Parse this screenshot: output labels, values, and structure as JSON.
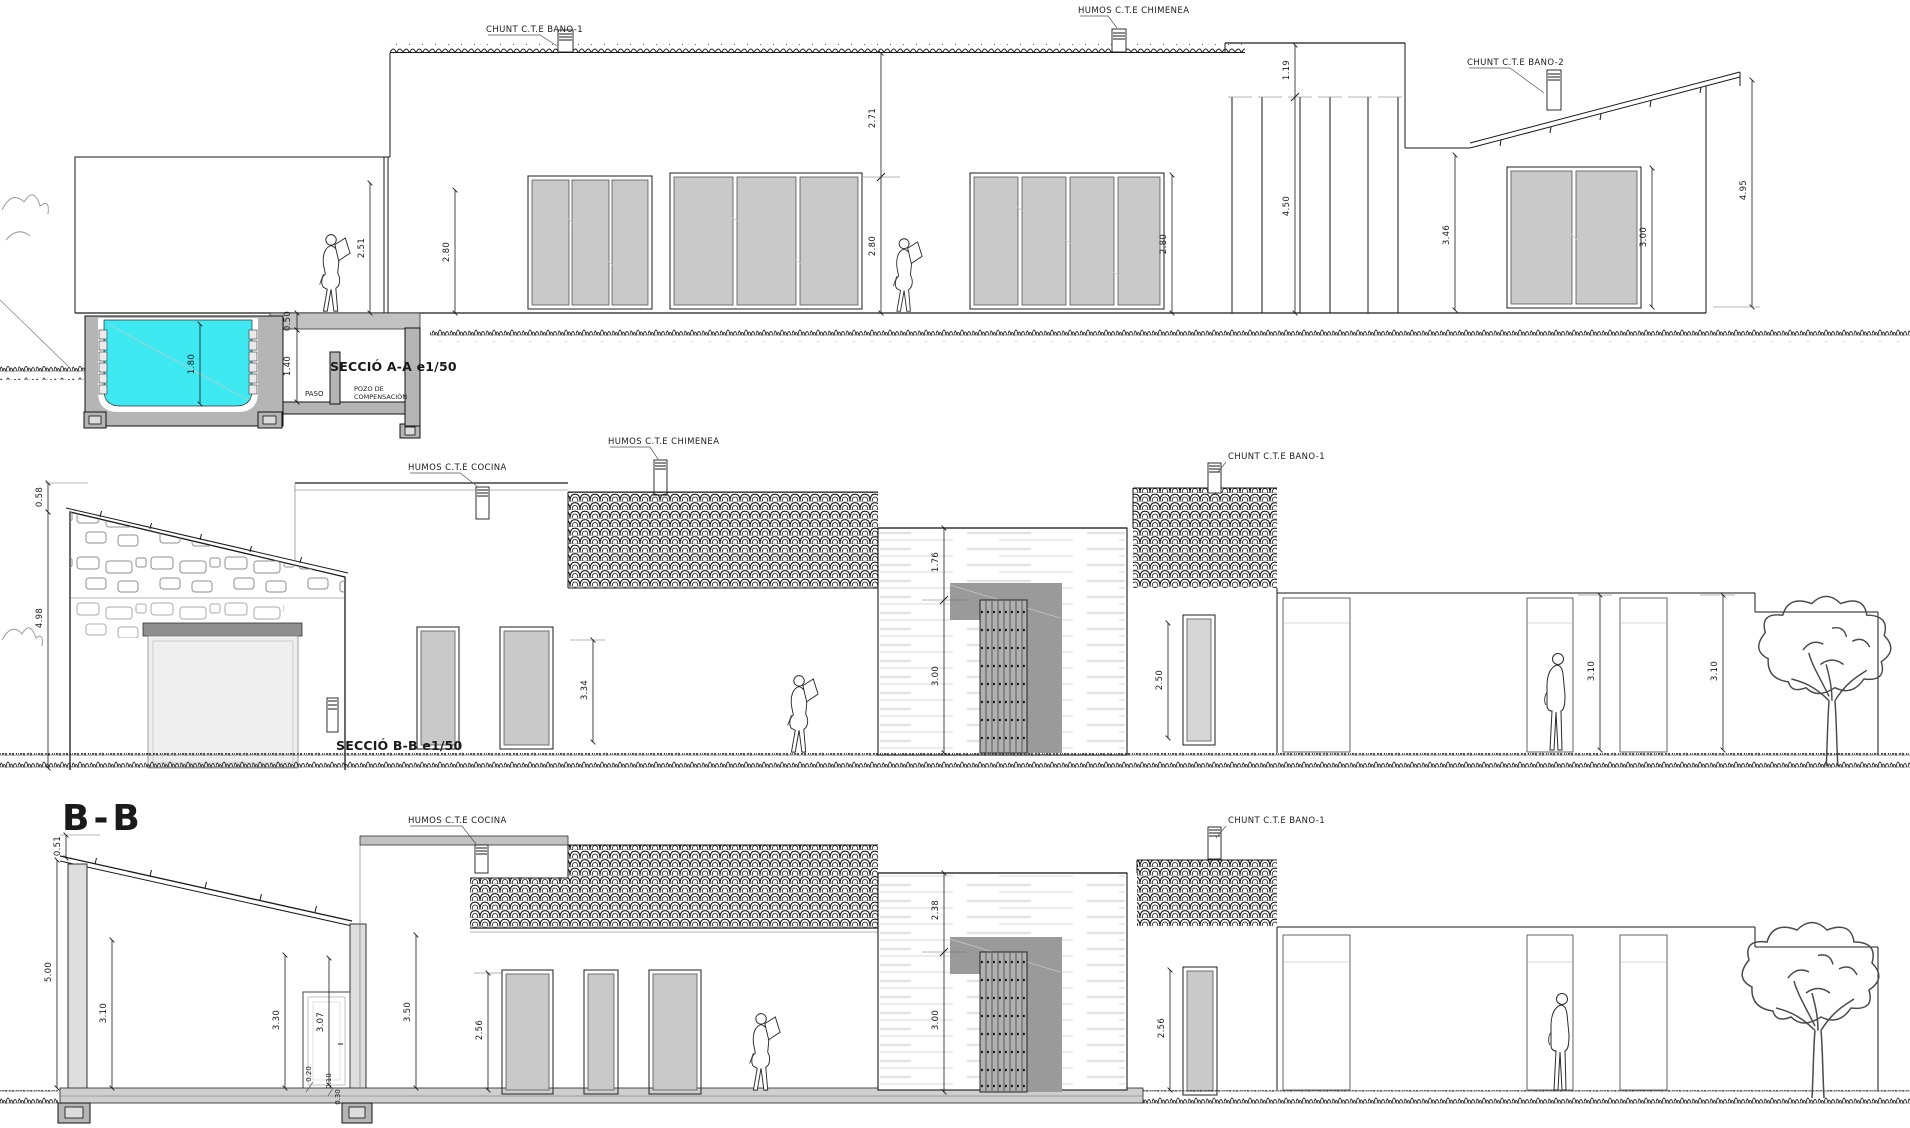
{
  "sheet": {
    "name": "House sections architectural drawing",
    "background": "#ffffff"
  },
  "colors": {
    "pool_water": "#3fe9f2",
    "panel_gray": "#c9c9c9",
    "recess_gray": "#9a9a9a",
    "line": "#1a1a1a"
  },
  "sectionA": {
    "title": "SECCIÓ A-A e1/50",
    "labels": {
      "bano1": "CHUNT C.T.E BANO-1",
      "chimenea": "HUMOS C.T.E CHIMENEA",
      "bano2": "CHUNT C.T.E BANO-2",
      "paso": "PASO",
      "pozo1": "POZO DE",
      "pozo2": "COMPENSACIÓN"
    },
    "dims": {
      "v271": "2.71",
      "v280a": "2.80",
      "v251": "2.51",
      "v280b": "2.80",
      "v280c": "2.80",
      "v119": "1.19",
      "v450": "4.50",
      "v346": "3.46",
      "v300": "3.00",
      "v495": "4.95",
      "v180": "1.80",
      "v050": "0.50",
      "v140": "1.40"
    }
  },
  "sectionB": {
    "title": "SECCIÓ B-B e1/50",
    "labels": {
      "cocina": "HUMOS C.T.E COCINA",
      "chimenea": "HUMOS C.T.E CHIMENEA",
      "bano1": "CHUNT C.T.E BANO-1"
    },
    "dims": {
      "v058": "0.58",
      "v498": "4.98",
      "v334": "3.34",
      "v176": "1.76",
      "v300": "3.00",
      "v250": "2.50",
      "v310a": "3.10",
      "v310b": "3.10"
    }
  },
  "sectionBB": {
    "title": "B-B",
    "labels": {
      "cocina": "HUMOS C.T.E COCINA",
      "bano1": "CHUNT C.T.E BANO-1"
    },
    "dims": {
      "v051": "0.51",
      "v500": "5.00",
      "v310": "3.10",
      "v330": "3.30",
      "v307": "3.07",
      "v020": "0.20",
      "v010": "0.10",
      "v030": "0.30",
      "v350": "3.50",
      "v256a": "2.56",
      "v238": "2.38",
      "v300": "3.00",
      "v256b": "2.56"
    }
  }
}
